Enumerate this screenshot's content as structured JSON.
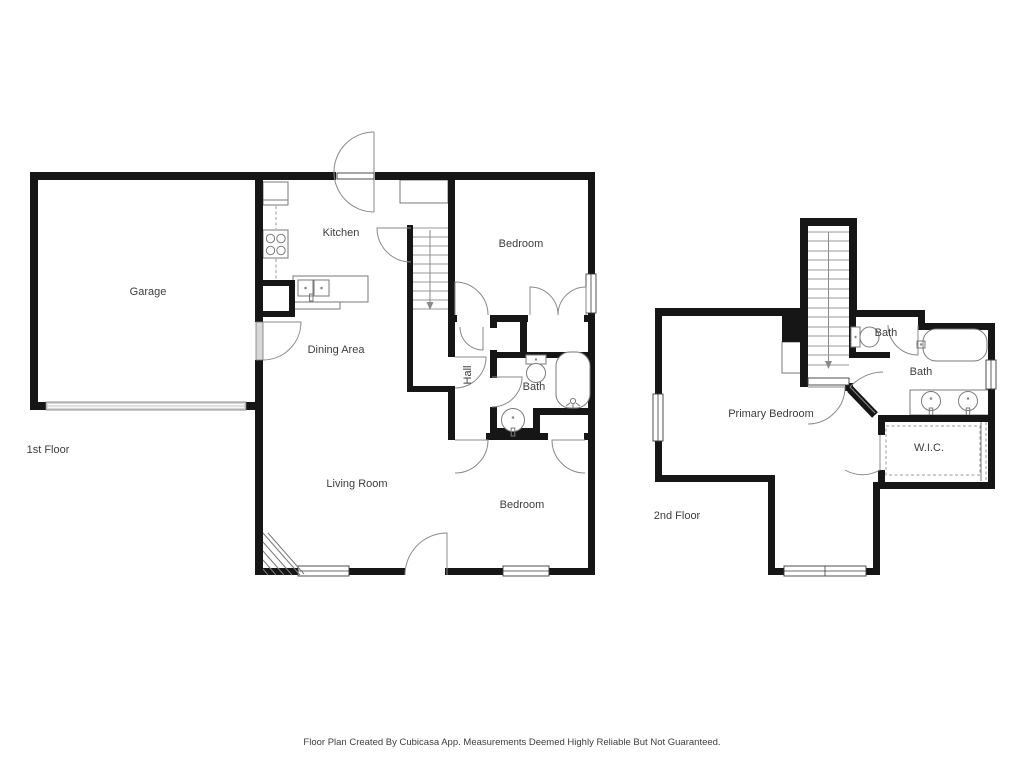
{
  "colors": {
    "background": "#ffffff",
    "wall": "#161616",
    "fixture_line": "#7a7a7a",
    "door_arc": "#8a8a8a",
    "text": "#3d3d3d",
    "garage_door": "#d8d8d8"
  },
  "floor1": {
    "name": "1st Floor",
    "rooms": {
      "garage": "Garage",
      "kitchen": "Kitchen",
      "dining": "Dining Area",
      "living": "Living Room",
      "hall": "Hall",
      "bath": "Bath",
      "bedroom_top": "Bedroom",
      "bedroom_bottom": "Bedroom"
    }
  },
  "floor2": {
    "name": "2nd Floor",
    "rooms": {
      "primary_bedroom": "Primary Bedroom",
      "bath_small": "Bath",
      "bath_main": "Bath",
      "wic": "W.I.C."
    }
  },
  "footer": {
    "disclaimer": "Floor Plan Created By Cubicasa App. Measurements Deemed Highly Reliable But Not Guaranteed."
  }
}
